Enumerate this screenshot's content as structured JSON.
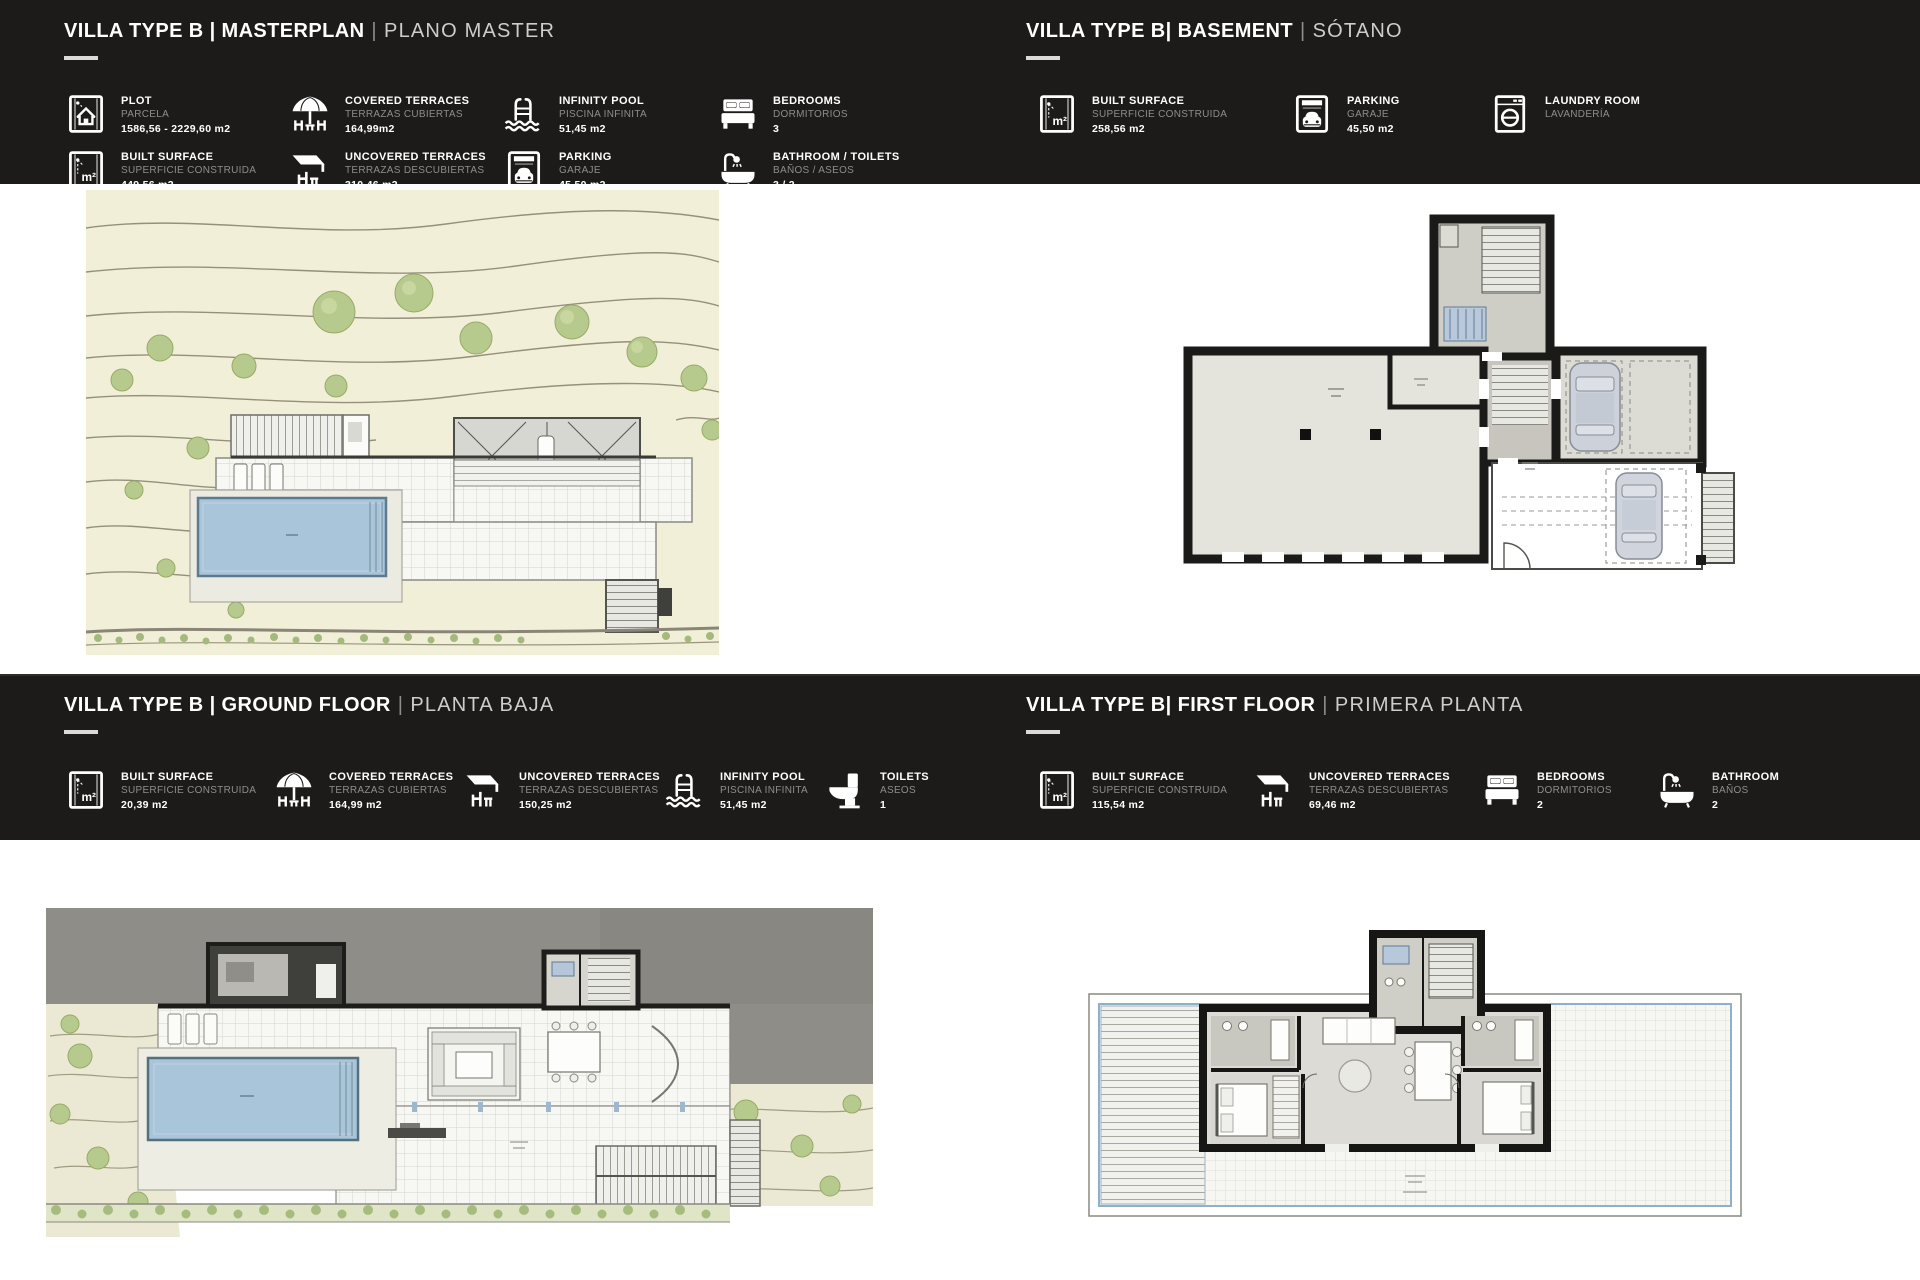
{
  "colors": {
    "band": "#1d1b1a",
    "page": "#ffffff",
    "muted_label": "#8f8d8a",
    "plan_cream": "#f1efd8",
    "pool_blue": "#a9c5da",
    "wall_black": "#1a1a19",
    "tree_green": "#b6ca8e"
  },
  "sections": {
    "masterplan": {
      "title": "VILLA TYPE B | MASTERPLAN",
      "sep": "|",
      "subtitle": "PLANO MASTER",
      "stats": [
        {
          "icon": "plot-icon",
          "label": "PLOT",
          "label_es": "PARCELA",
          "value": "1586,56 - 2229,60 m2"
        },
        {
          "icon": "covered-terrace-icon",
          "label": "COVERED TERRACES",
          "label_es": "TERRAZAS CUBIERTAS",
          "value": "164,99m2"
        },
        {
          "icon": "infinity-pool-icon",
          "label": "INFINITY POOL",
          "label_es": "PISCINA INFINITA",
          "value": "51,45 m2"
        },
        {
          "icon": "bedrooms-icon",
          "label": "BEDROOMS",
          "label_es": "DORMITORIOS",
          "value": "3"
        },
        {
          "icon": "built-surface-icon",
          "label": "BUILT SURFACE",
          "label_es": "SUPERFICIE CONSTRUIDA",
          "value": "449,56 m2"
        },
        {
          "icon": "uncovered-terrace-icon",
          "label": "UNCOVERED TERRACES",
          "label_es": "TERRAZAS DESCUBIERTAS",
          "value": "310,46 m2"
        },
        {
          "icon": "parking-icon",
          "label": "PARKING",
          "label_es": "GARAJE",
          "value": "45,50 m2"
        },
        {
          "icon": "bathroom-icon",
          "label": "BATHROOM / TOILETS",
          "label_es": "BAÑOS / ASEOS",
          "value": "3 / 2"
        }
      ]
    },
    "basement": {
      "title": "VILLA TYPE B| BASEMENT",
      "sep": "|",
      "subtitle": "SÓTANO",
      "stats": [
        {
          "icon": "built-surface-icon",
          "label": "BUILT SURFACE",
          "label_es": "SUPERFICIE CONSTRUIDA",
          "value": "258,56 m2"
        },
        {
          "icon": "parking-icon",
          "label": "PARKING",
          "label_es": "GARAJE",
          "value": "45,50 m2"
        },
        {
          "icon": "laundry-icon",
          "label": "LAUNDRY ROOM",
          "label_es": "LAVANDERÍA",
          "value": ""
        }
      ]
    },
    "groundfloor": {
      "title": "VILLA TYPE B | GROUND FLOOR",
      "sep": "|",
      "subtitle": "PLANTA BAJA",
      "stats": [
        {
          "icon": "built-surface-icon",
          "label": "BUILT SURFACE",
          "label_es": "SUPERFICIE CONSTRUIDA",
          "value": "20,39 m2"
        },
        {
          "icon": "covered-terrace-icon",
          "label": "COVERED TERRACES",
          "label_es": "TERRAZAS CUBIERTAS",
          "value": "164,99 m2"
        },
        {
          "icon": "uncovered-terrace-icon",
          "label": "UNCOVERED TERRACES",
          "label_es": "TERRAZAS DESCUBIERTAS",
          "value": "150,25 m2"
        },
        {
          "icon": "infinity-pool-icon",
          "label": "INFINITY POOL",
          "label_es": "PISCINA INFINITA",
          "value": "51,45 m2"
        },
        {
          "icon": "toilets-icon",
          "label": "TOILETS",
          "label_es": "ASEOS",
          "value": "1"
        }
      ]
    },
    "firstfloor": {
      "title": "VILLA TYPE B| FIRST FLOOR",
      "sep": "|",
      "subtitle": "PRIMERA PLANTA",
      "stats": [
        {
          "icon": "built-surface-icon",
          "label": "BUILT SURFACE",
          "label_es": "SUPERFICIE CONSTRUIDA",
          "value": "115,54 m2"
        },
        {
          "icon": "uncovered-terrace-icon",
          "label": "UNCOVERED TERRACES",
          "label_es": "TERRAZAS DESCUBIERTAS",
          "value": "69,46 m2"
        },
        {
          "icon": "bedrooms-icon",
          "label": "BEDROOMS",
          "label_es": "DORMITORIOS",
          "value": "2"
        },
        {
          "icon": "bathroom-icon",
          "label": "BATHROOM",
          "label_es": "BAÑOS",
          "value": "2"
        }
      ]
    }
  }
}
